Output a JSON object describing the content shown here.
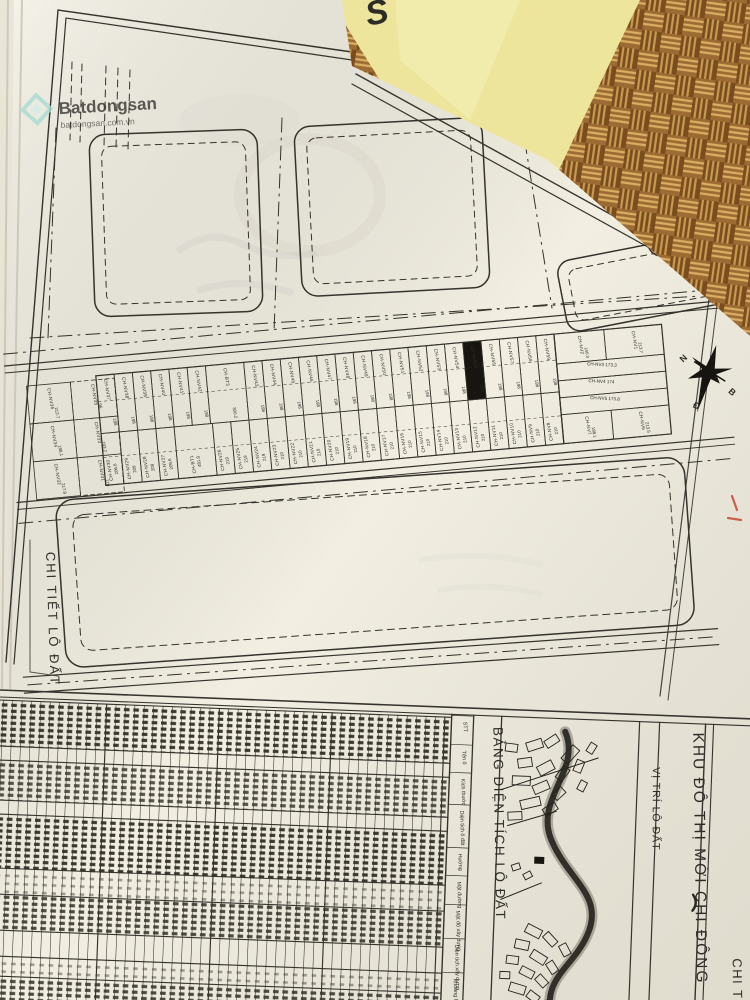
{
  "watermark": {
    "brand": "Batdongsan",
    "sub": "batdongsan.com.vn"
  },
  "plan": {
    "left_title": "CHI TIẾT LÔ ĐẤT",
    "highlight": {
      "name": "CH-NV55",
      "area": "198"
    },
    "compass": {
      "letters": [
        "N",
        "B",
        "Đ"
      ]
    },
    "lots": {
      "left_cluster": [
        {
          "name": "CH-NV36",
          "area": "212.7"
        },
        {
          "name": "CH-NV35",
          "area": "96"
        },
        {
          "name": "CH-NV34",
          "area": "198.1"
        },
        {
          "name": "CH-NV33",
          "area": "193.2"
        },
        {
          "name": "CH-NV32",
          "area": "217.8"
        },
        {
          "name": "CH-NV31",
          "area": "170"
        }
      ],
      "top_row": [
        {
          "name": "CH-NV37",
          "area": "198"
        },
        {
          "name": "CH-NV38",
          "area": "198"
        },
        {
          "name": "CH-NV39",
          "area": "198"
        },
        {
          "name": "CH-NV40",
          "area": "198"
        },
        {
          "name": "CH-NV41",
          "area": "198"
        },
        {
          "name": "CH-NV42",
          "area": "198"
        },
        {
          "name": "CH-BT3",
          "area": "300.2",
          "wide": true
        },
        {
          "name": "CH-NV43",
          "area": "198"
        },
        {
          "name": "CH-NV44",
          "area": "198"
        },
        {
          "name": "CH-NV45",
          "area": "198"
        },
        {
          "name": "CH-NV46",
          "area": "198"
        },
        {
          "name": "CH-NV47",
          "area": "198"
        },
        {
          "name": "CH-NV48",
          "area": "198"
        },
        {
          "name": "CH-NV49",
          "area": "198"
        },
        {
          "name": "CH-NV50",
          "area": "198"
        },
        {
          "name": "CH-NV51",
          "area": "198"
        },
        {
          "name": "CH-NV52",
          "area": "198"
        },
        {
          "name": "CH-NV53",
          "area": "198"
        },
        {
          "name": "CH-NV54",
          "area": "198"
        },
        {
          "name": "CH-NV55",
          "area": "198"
        },
        {
          "name": "CH-NV56",
          "area": "198"
        },
        {
          "name": "CH-NV57",
          "area": "198"
        },
        {
          "name": "CH-NV58",
          "area": "198"
        },
        {
          "name": "CH-NV59",
          "area": "198"
        }
      ],
      "bottom_row": [
        {
          "name": "CH-NV30",
          "area": "206.6"
        },
        {
          "name": "CH-NV29",
          "area": "209"
        },
        {
          "name": "CH-NV28",
          "area": "209"
        },
        {
          "name": "CH-NV27",
          "area": "209.6"
        },
        {
          "name": "CH-BT1",
          "area": "481.9",
          "wide": true
        },
        {
          "name": "CH-NV26",
          "area": "219"
        },
        {
          "name": "CH-NV25",
          "area": "219"
        },
        {
          "name": "CH-NV24",
          "area": "219"
        },
        {
          "name": "CH-NV23",
          "area": "210"
        },
        {
          "name": "CH-NV22",
          "area": "210"
        },
        {
          "name": "CH-NV21",
          "area": "210"
        },
        {
          "name": "CH-NV20",
          "area": "210"
        },
        {
          "name": "CH-NV19",
          "area": "210"
        },
        {
          "name": "CH-NV18",
          "area": "210"
        },
        {
          "name": "CH-NV17",
          "area": "210"
        },
        {
          "name": "CH-NV16",
          "area": "210"
        },
        {
          "name": "CH-NV15",
          "area": "210"
        },
        {
          "name": "CH-NV14",
          "area": "210"
        },
        {
          "name": "CH-NV13",
          "area": "210"
        },
        {
          "name": "CH-NV12",
          "area": "210"
        },
        {
          "name": "CH-NV11",
          "area": "210"
        },
        {
          "name": "CH-NV10",
          "area": "210"
        },
        {
          "name": "CH-NV9",
          "area": "210"
        },
        {
          "name": "CH-NV8",
          "area": "210"
        }
      ],
      "corner_block": [
        {
          "name": "CH-NV2",
          "area": "140.3"
        },
        {
          "name": "CH-NV1",
          "area": "213.7"
        },
        {
          "name": "CH-NV3",
          "area": "173.3"
        },
        {
          "name": "CH-NV4",
          "area": "174"
        },
        {
          "name": "CH-NV5",
          "area": "173.8"
        },
        {
          "name": "CH-NV7",
          "area": "198.1"
        },
        {
          "name": "CH-NV6",
          "area": "213.5"
        }
      ]
    }
  },
  "bottom": {
    "table_title": "BẢNG DIỆN TÍCH LÔ ĐẤT",
    "columns": [
      "STT",
      "Tên ô",
      "Kích thước",
      "Diện tích ô đất",
      "Hướng",
      "Mặt đường",
      "Mật độ xây dựng",
      "Diện tích xây dựng",
      "Khoảng lùi Trước",
      "Sau"
    ],
    "inset_title": "VỊ TRÍ LÔ ĐẤT",
    "right_title": "KHU ĐÔ THỊ MỚI CHI ĐÔNG",
    "corner_label": "CHI TIẾT"
  },
  "colors": {
    "paper": "#f2efe2",
    "ink": "#35332c",
    "mat_dark": "#5e3a16",
    "mat_mid": "#9c6b33",
    "mat_light": "#d9ae62",
    "yellow_paper": "#ece59b",
    "logo_blue": "#1d2e86",
    "watermark_teal": "#a8dcd3",
    "highlight_black": "#17150f",
    "red_mark": "#c4473a"
  }
}
